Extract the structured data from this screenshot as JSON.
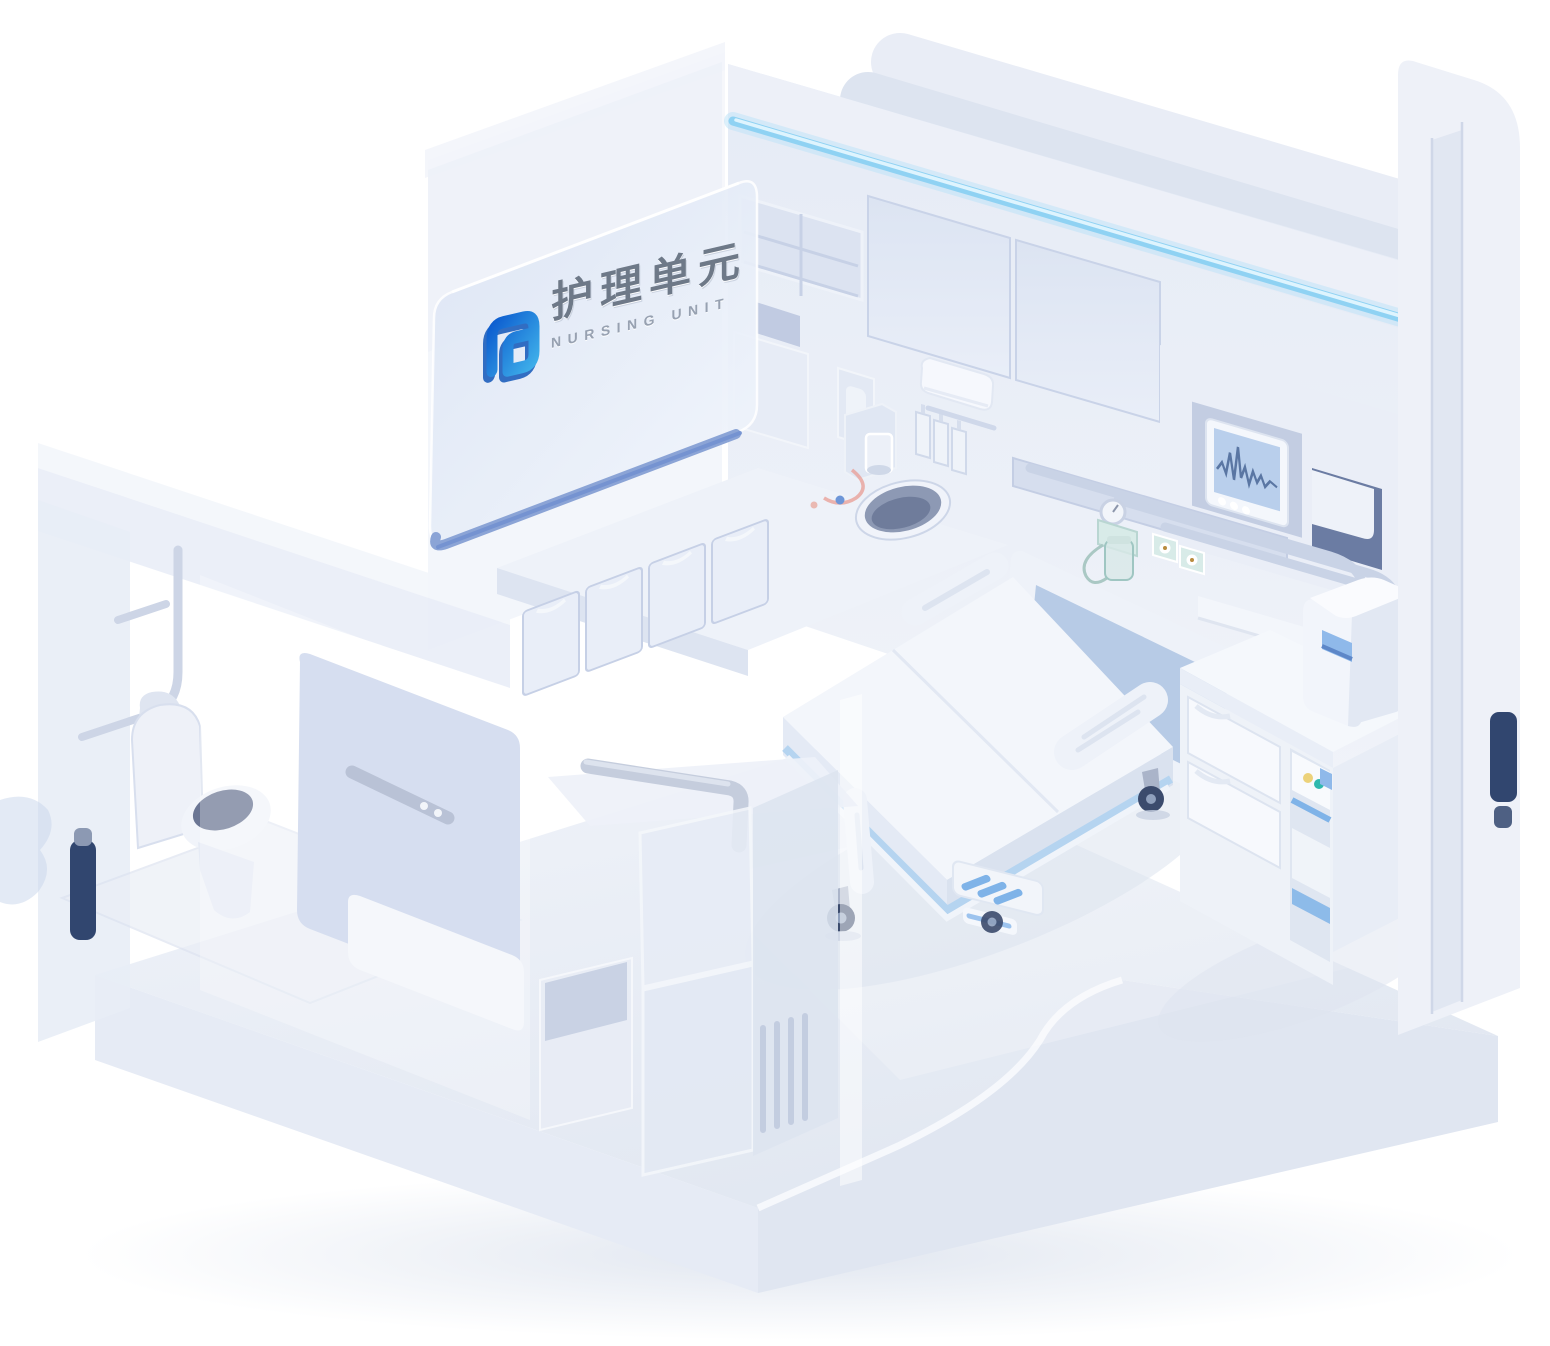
{
  "sign": {
    "title_cn": "护理单元",
    "title_en": "NURSING UNIT"
  },
  "branding": {
    "logo_blue_start": "#0e5fd0",
    "logo_blue_end": "#3dade9"
  },
  "accents": {
    "light_strip": "#8fd2f3",
    "headboard_blue": "#b7cbe6",
    "navy_base": "#31466f",
    "screen_blue": "#b9cfec",
    "handle_blue": "#8fb9ea",
    "device_button_yellow": "#ecd27a",
    "device_button_teal": "#2fb9ae",
    "gas_outlet_teal": "#d8ebe8"
  },
  "icons": {
    "logo": "rounded-square-spiral",
    "monitor_waveform": "ecg-line"
  }
}
